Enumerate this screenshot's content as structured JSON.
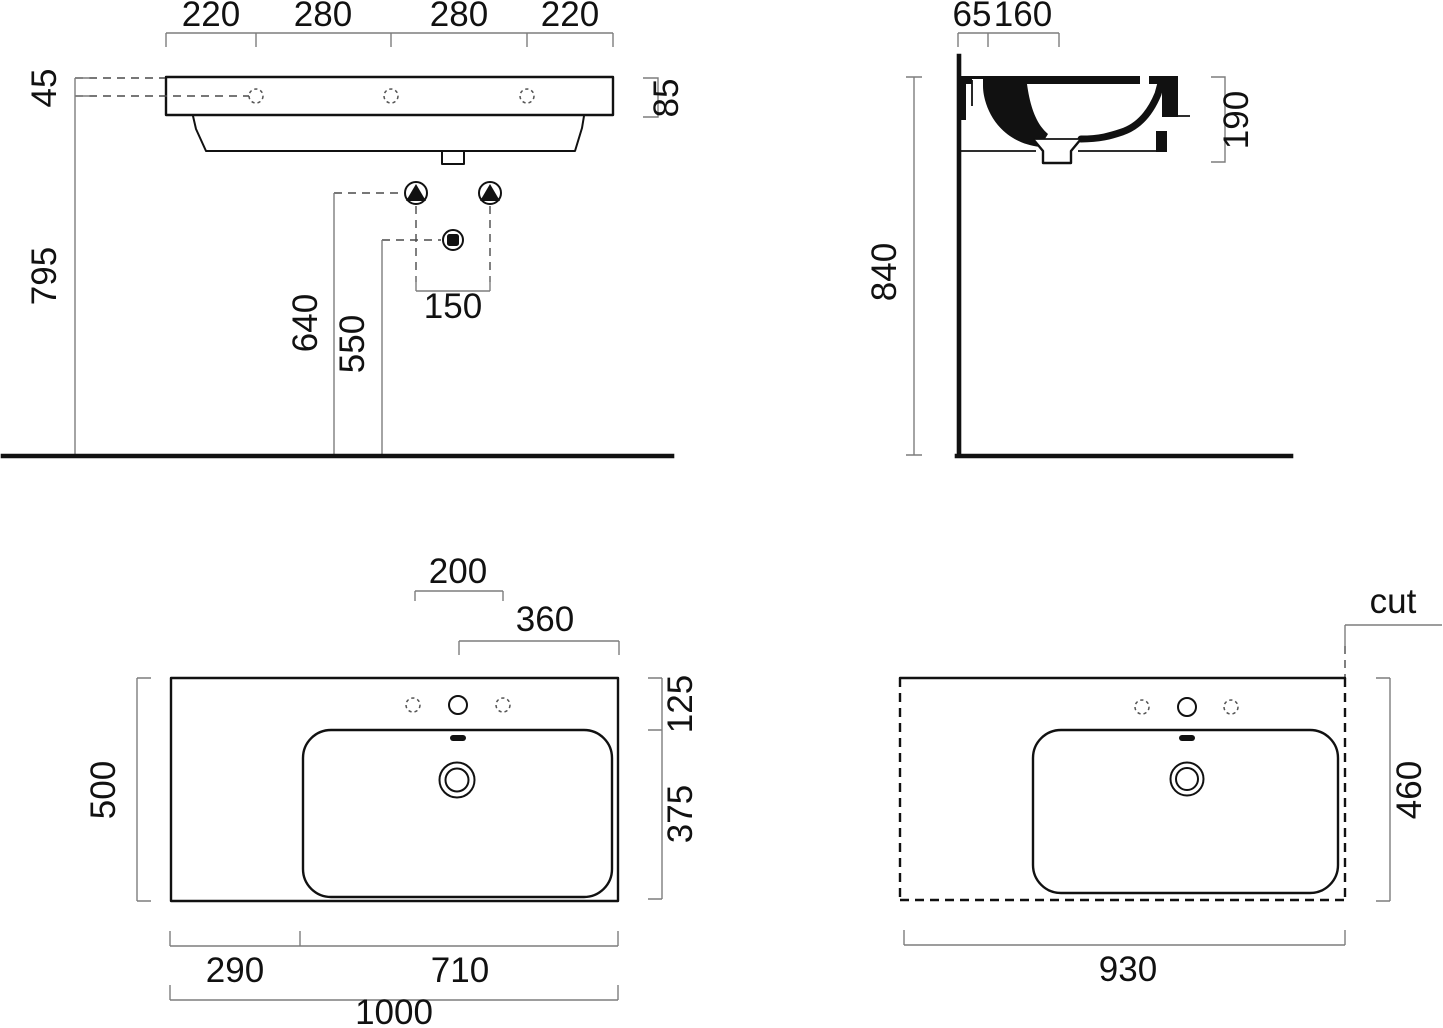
{
  "colors": {
    "object_line": "#111111",
    "dimension_line": "#7d7d7d",
    "background": "#ffffff"
  },
  "front_view": {
    "top_dims": [
      "220",
      "280",
      "280",
      "220"
    ],
    "rim_to_holes": "45",
    "floor_to_holes": "795",
    "rim_height": "85",
    "bolt_height": "640",
    "drain_height": "550",
    "bolt_spacing": "150"
  },
  "side_view": {
    "top_dims": [
      "65",
      "160"
    ],
    "basin_depth": "190",
    "floor_to_rim": "840"
  },
  "plan_view": {
    "tap_spacing": "200",
    "tap_to_edge": "360",
    "depth": "500",
    "back_ledge": "125",
    "bowl_depth": "375",
    "left_ledge": "290",
    "bowl_width": "710",
    "total_width": "1000"
  },
  "cut_view": {
    "cut_label": "cut",
    "depth": "460",
    "width": "930"
  }
}
